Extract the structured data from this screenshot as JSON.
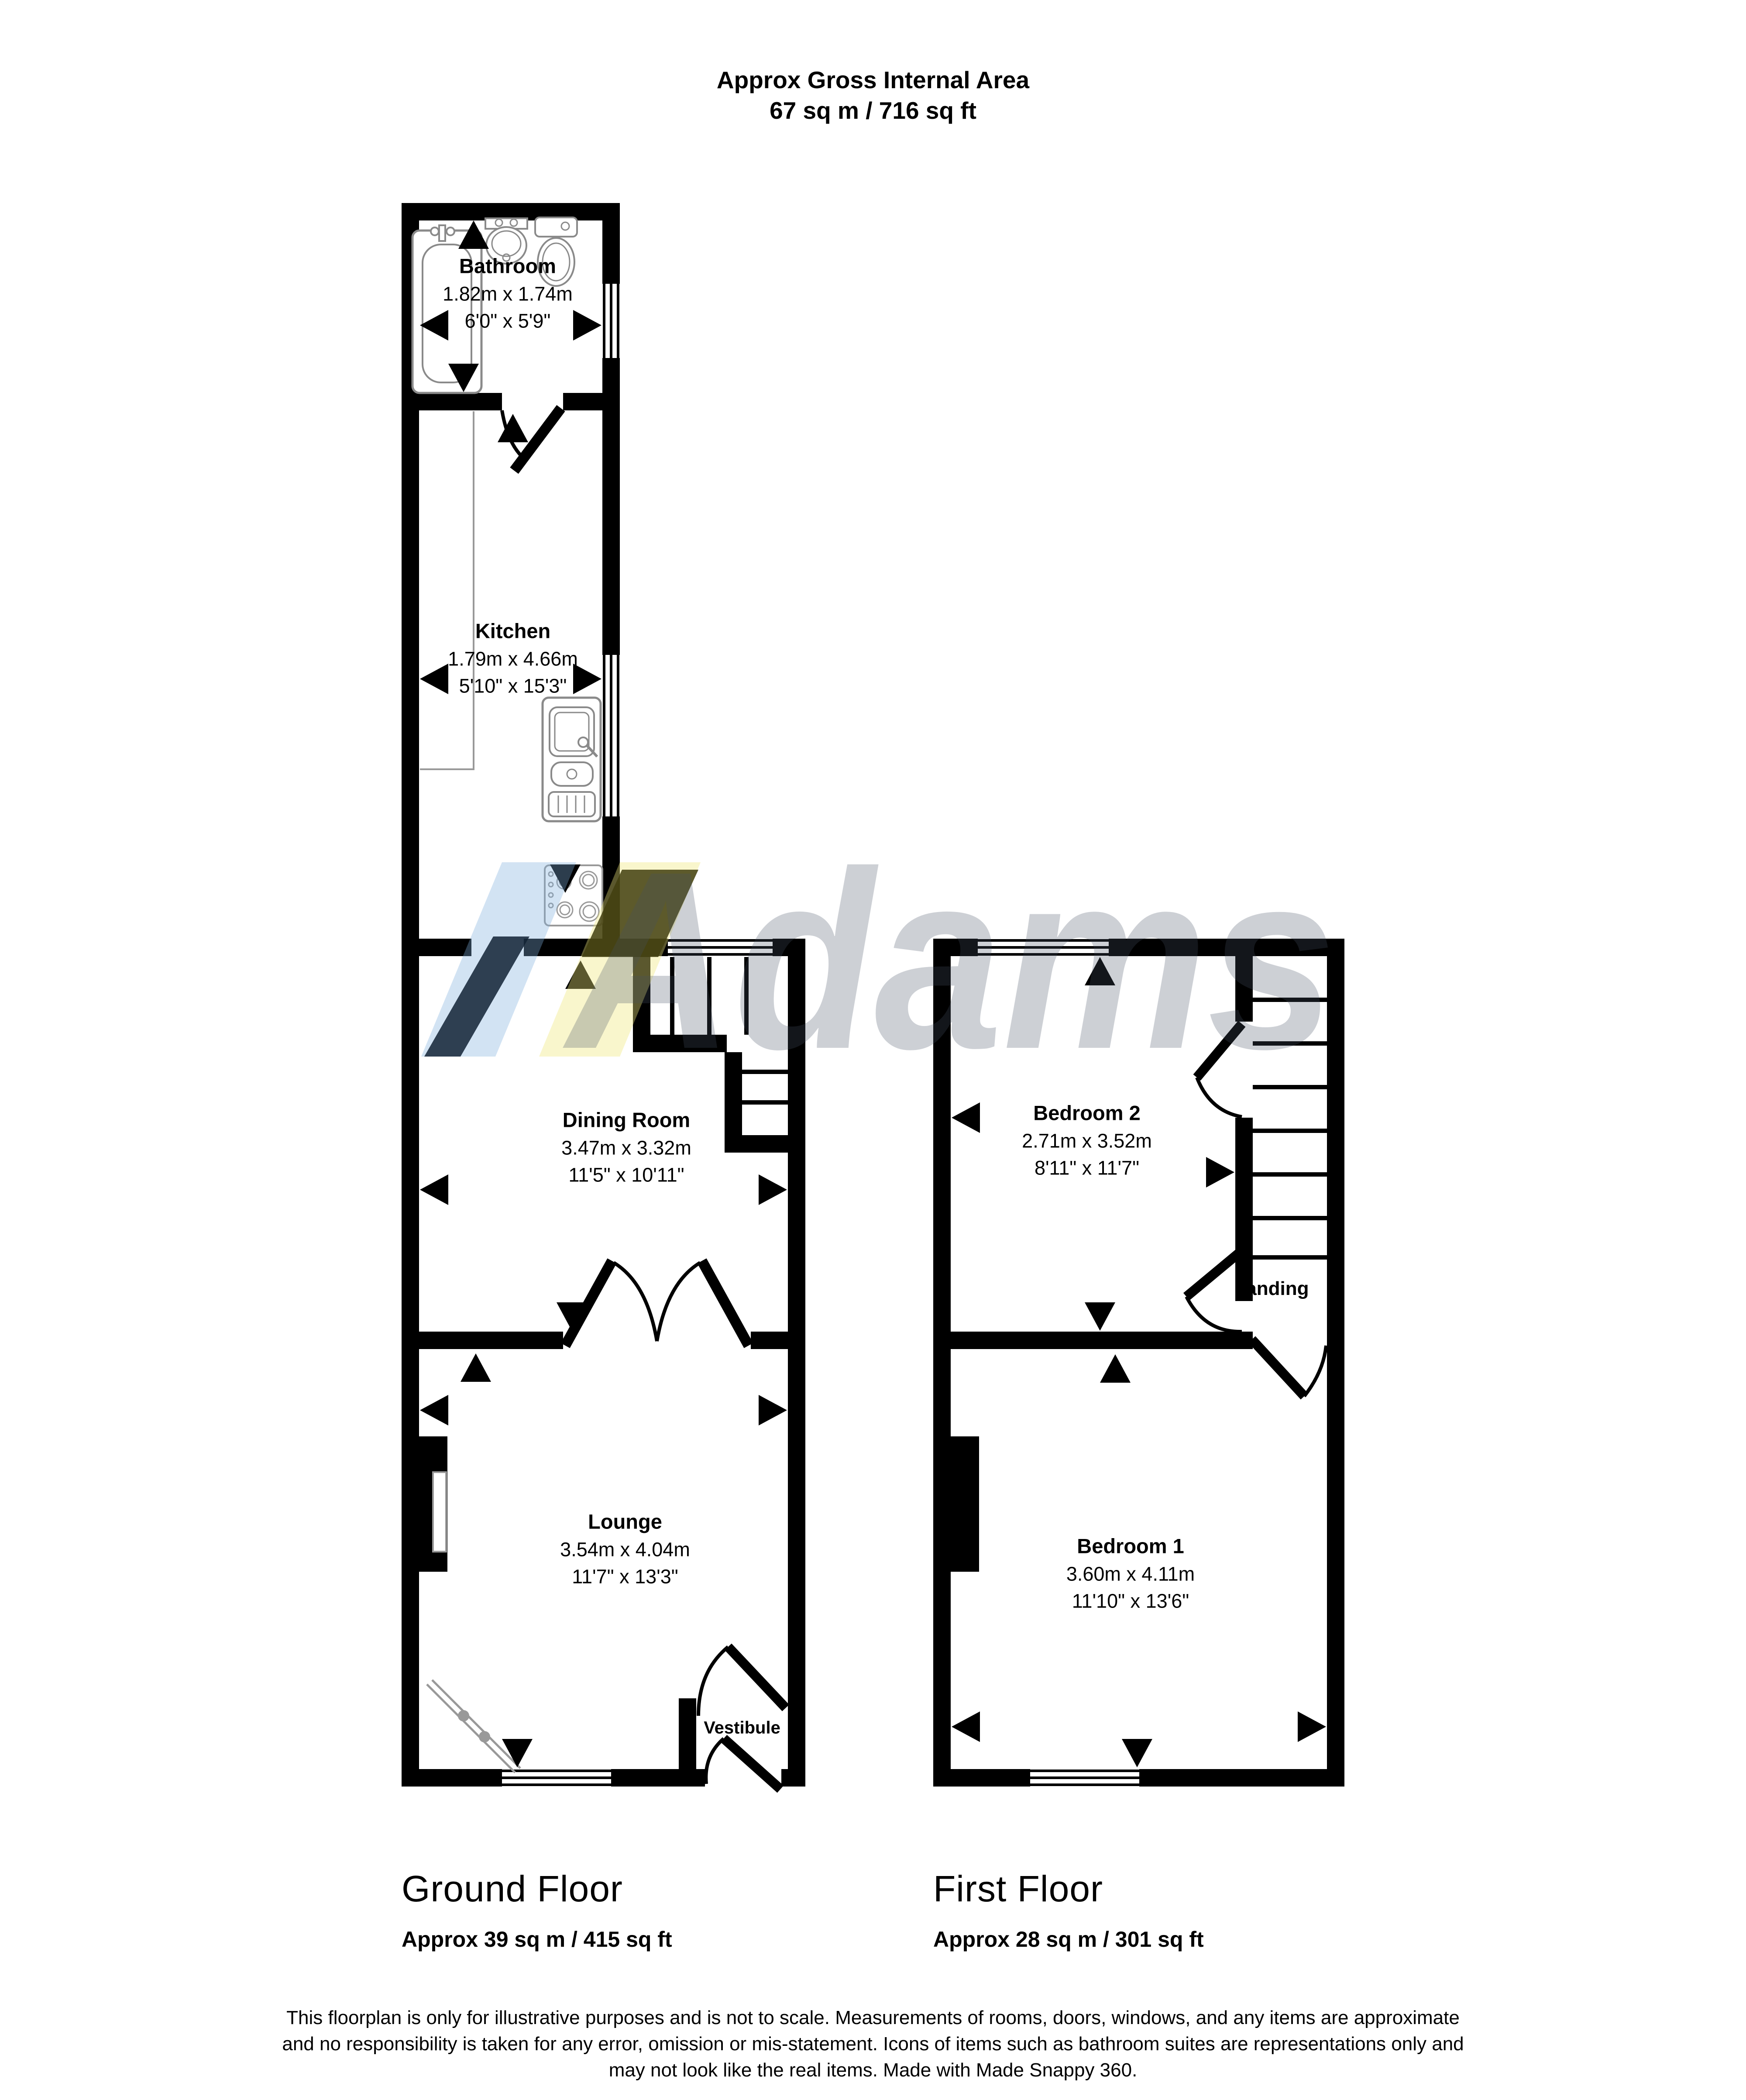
{
  "title": {
    "line1": "Approx Gross Internal Area",
    "line2": "67 sq m / 716 sq ft"
  },
  "watermark": {
    "text": "Adams"
  },
  "ground_floor": {
    "label": "Ground Floor",
    "area": "Approx 39 sq m / 415 sq ft",
    "rooms": {
      "bathroom": {
        "name": "Bathroom",
        "metric": "1.82m x 1.74m",
        "imperial": "6'0\" x 5'9\""
      },
      "kitchen": {
        "name": "Kitchen",
        "metric": "1.79m x 4.66m",
        "imperial": "5'10\" x 15'3\""
      },
      "dining_room": {
        "name": "Dining Room",
        "metric": "3.47m x 3.32m",
        "imperial": "11'5\" x 10'11\""
      },
      "lounge": {
        "name": "Lounge",
        "metric": "3.54m x 4.04m",
        "imperial": "11'7\" x 13'3\""
      },
      "vestibule": {
        "name": "Vestibule"
      }
    }
  },
  "first_floor": {
    "label": "First Floor",
    "area": "Approx 28 sq m / 301 sq ft",
    "rooms": {
      "bedroom2": {
        "name": "Bedroom 2",
        "metric": "2.71m x 3.52m",
        "imperial": "8'11\" x 11'7\""
      },
      "landing": {
        "name": "Landing"
      },
      "bedroom1": {
        "name": "Bedroom 1",
        "metric": "3.60m x 4.11m",
        "imperial": "11'10\" x 13'6\""
      }
    }
  },
  "footer": {
    "line1": "This floorplan is only for illustrative purposes and is not to scale. Measurements of rooms, doors, windows, and any items are approximate",
    "line2": "and no responsibility is taken for any error, omission or mis-statement. Icons of items such as bathroom suites are representations only and",
    "line3": "may not look like the real items. Made with Made Snappy 360."
  },
  "colors": {
    "wall": "#000000",
    "fixture_gray": "#8a8a8a",
    "watermark_gray": "#c9ccd3",
    "watermark_blue": "#d9e9f7",
    "watermark_yellow": "#fbf7d0"
  }
}
